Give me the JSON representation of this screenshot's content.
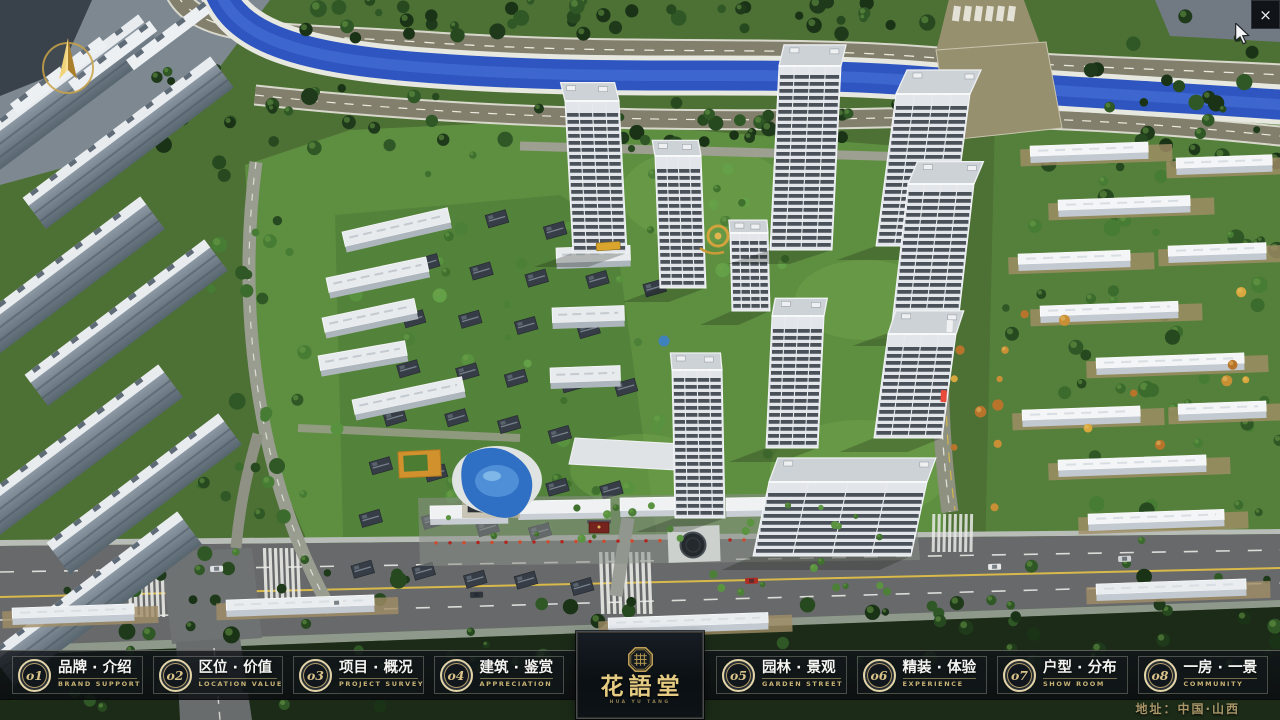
{
  "window": {
    "close_label": "×"
  },
  "navbar": {
    "items": [
      {
        "num": "o1",
        "title": "品牌 · 介绍",
        "subtitle": "BRAND SUPPORT"
      },
      {
        "num": "o2",
        "title": "区位 · 价值",
        "subtitle": "LOCATION VALUE"
      },
      {
        "num": "o3",
        "title": "项目 · 概况",
        "subtitle": "PROJECT SURVEY"
      },
      {
        "num": "o4",
        "title": "建筑 · 鉴赏",
        "subtitle": "APPRECIATION"
      },
      {
        "num": "o5",
        "title": "园林 · 景观",
        "subtitle": "GARDEN STREET"
      },
      {
        "num": "o6",
        "title": "精装 · 体验",
        "subtitle": "EXPERIENCE"
      },
      {
        "num": "o7",
        "title": "户型 · 分布",
        "subtitle": "SHOW ROOM"
      },
      {
        "num": "o8",
        "title": "一房 · 一景",
        "subtitle": "COMMUNITY"
      }
    ]
  },
  "logo": {
    "name": "花語堂",
    "tagline": "HUA YU TANG"
  },
  "footer": {
    "address": "地址：中国·山西"
  },
  "colors": {
    "accent_gold": "#d6c28a",
    "bar_background": "#10151a",
    "river_blue": "#2e55c0",
    "grass_green": "#5e8f41"
  }
}
